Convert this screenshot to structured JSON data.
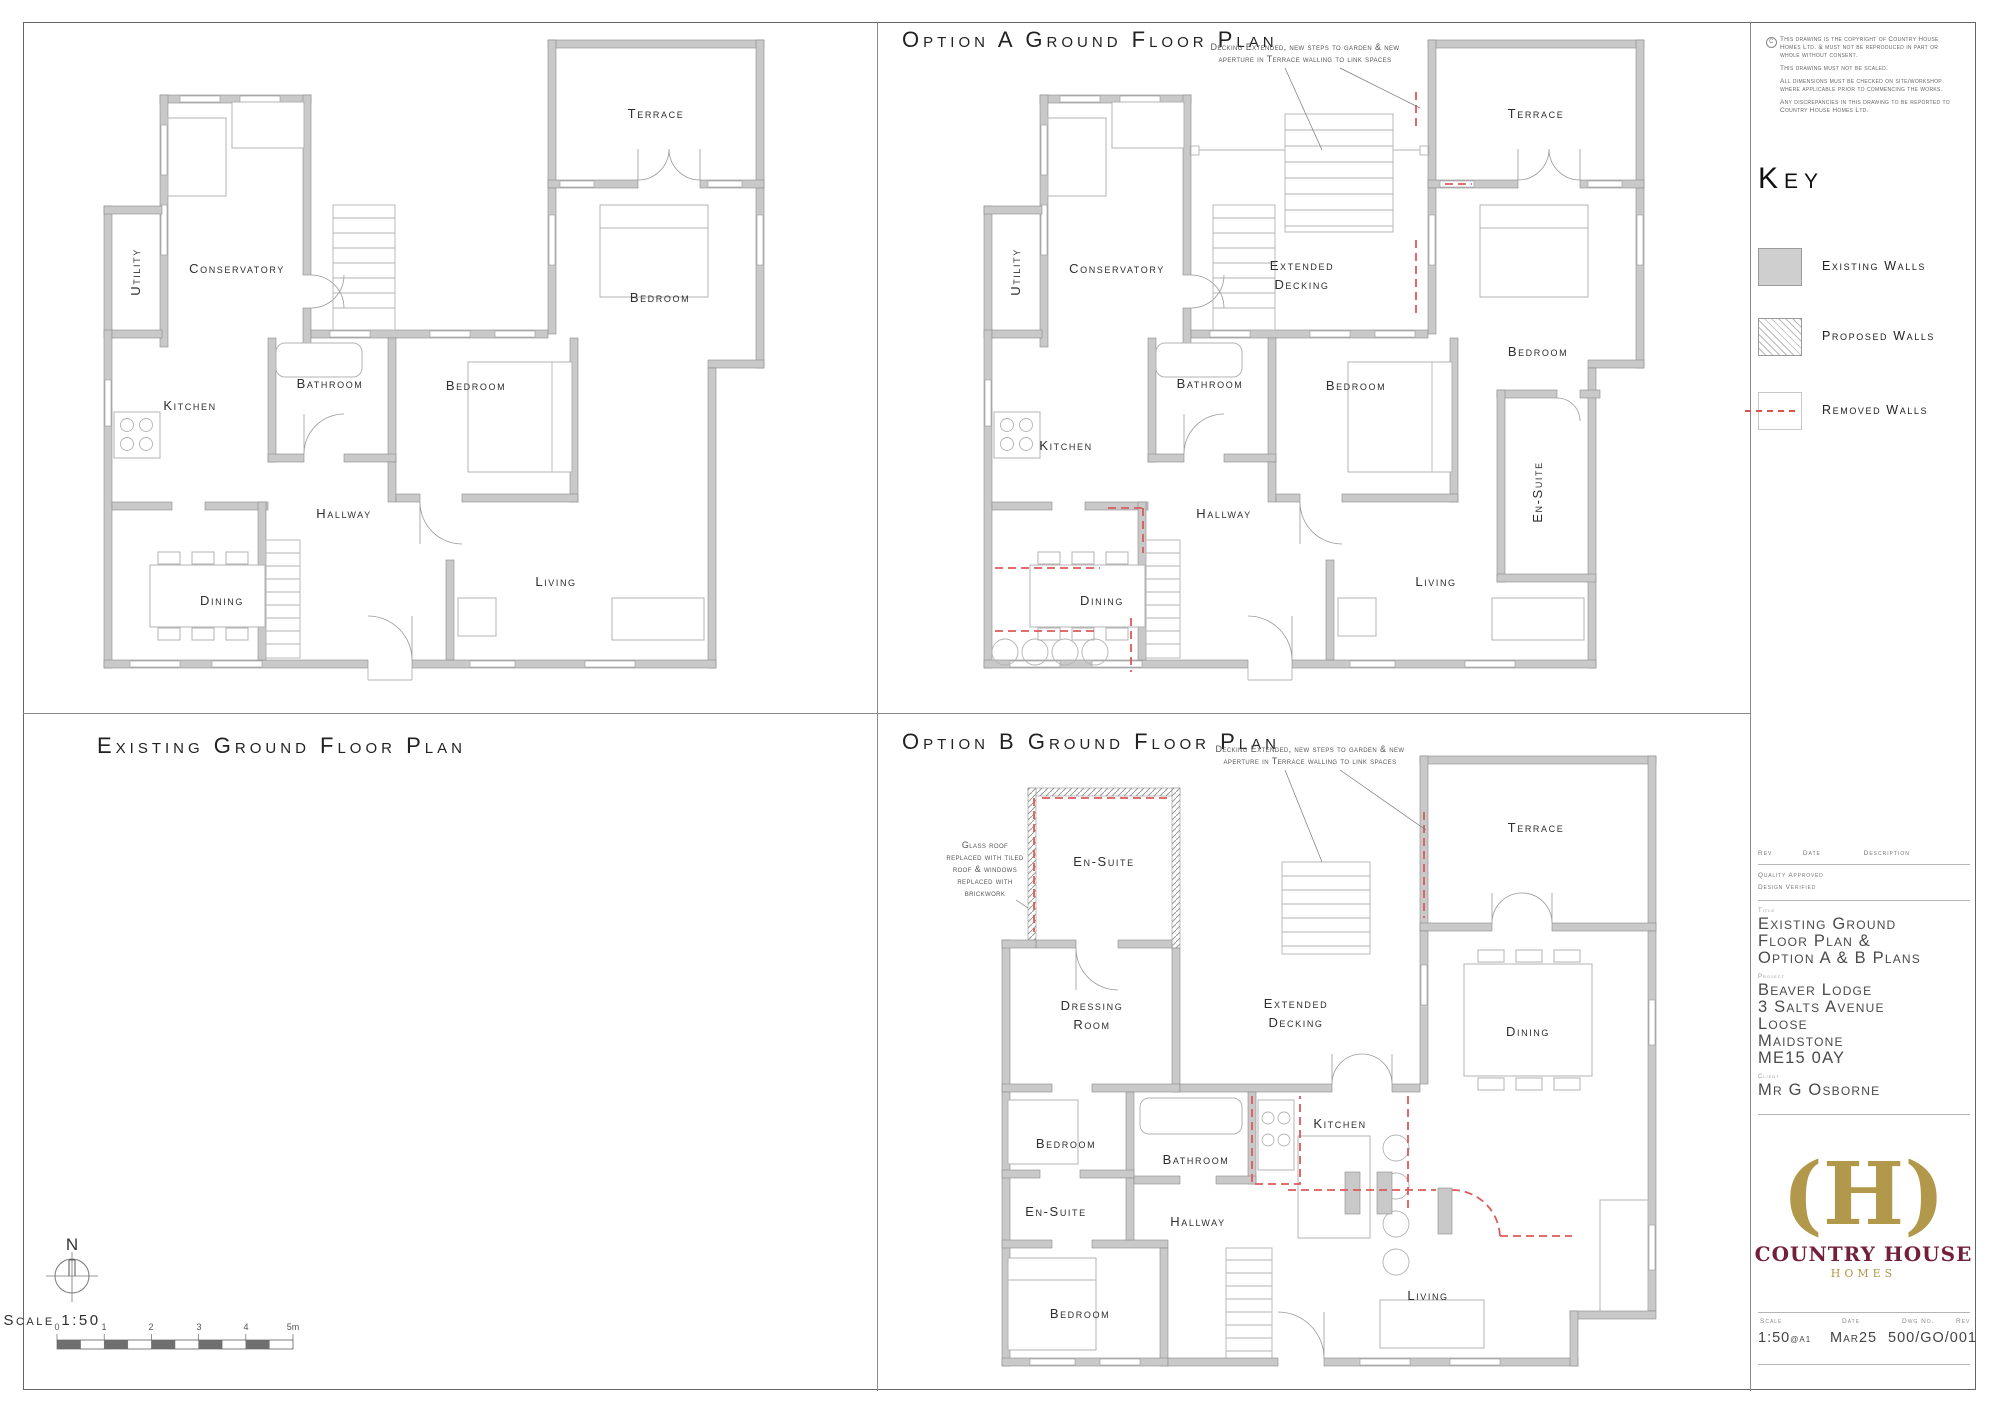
{
  "panels": {
    "existing_title": "Existing Ground Floor Plan",
    "option_a_title": "Option A Ground Floor Plan",
    "option_b_title": "Option B Ground Floor Plan"
  },
  "plans": {
    "existing": {
      "utility": "Utility",
      "conservatory": "Conservatory",
      "terrace": "Terrace",
      "kitchen": "Kitchen",
      "bathroom": "Bathroom",
      "bedroom_middle": "Bedroom",
      "bedroom_right": "Bedroom",
      "hallway": "Hallway",
      "dining": "Dining",
      "living": "Living"
    },
    "option_a": {
      "utility": "Utility",
      "conservatory": "Conservatory",
      "terrace": "Terrace",
      "kitchen": "Kitchen",
      "bathroom": "Bathroom",
      "bedroom_middle": "Bedroom",
      "bedroom_right": "Bedroom",
      "hallway": "Hallway",
      "dining": "Dining",
      "living": "Living",
      "en_suite": "En-Suite",
      "extended_decking_line1": "Extended",
      "extended_decking_line2": "Decking"
    },
    "option_b": {
      "en_suite_top": "En-Suite",
      "dressing_line1": "Dressing",
      "dressing_line2": "Room",
      "extended_decking_line1": "Extended",
      "extended_decking_line2": "Decking",
      "terrace": "Terrace",
      "dining": "Dining",
      "bedroom_middle": "Bedroom",
      "bathroom": "Bathroom",
      "kitchen": "Kitchen",
      "hallway": "Hallway",
      "en_suite_small": "En-Suite",
      "bedroom_bottom": "Bedroom",
      "living": "Living"
    }
  },
  "annotations": {
    "decking_line1": "Decking Extended, new steps to garden & new",
    "decking_line2": "aperture in Terrace walling to link spaces",
    "glass_lines": [
      "Glass roof",
      "replaced with tiled",
      "roof & windows",
      "replaced with",
      "brickwork"
    ]
  },
  "key": {
    "title": "Key",
    "items": [
      {
        "label": "Existing Walls"
      },
      {
        "label": "Proposed Walls"
      },
      {
        "label": "Removed Walls"
      }
    ]
  },
  "copyright": {
    "symbol": "c",
    "lines": [
      "This drawing is the copyright of Country House",
      "Homes Ltd. & must not be reproduced in part or",
      "whole without consent.",
      "This drawing must not be scaled.",
      "All dimensions must be checked on site/workshop",
      "where applicable prior to commencing the works.",
      "Any discrepancies in this drawing to be reported to",
      "Country House Homes Ltd."
    ]
  },
  "revision": {
    "rev_header": "Rev",
    "date_header": "Date",
    "description_header": "Description",
    "quality": "Quality Approved",
    "design": "Design Verified"
  },
  "title_block": {
    "title_label": "Title",
    "title_lines": [
      "Existing Ground",
      "Floor Plan &",
      "Option A & B Plans"
    ],
    "project_label": "Project",
    "project_lines": [
      "Beaver Lodge",
      "3 Salts Avenue",
      "Loose",
      "Maidstone",
      "ME15 0AY"
    ],
    "client_label": "Client",
    "client": "Mr G Osborne"
  },
  "logo": {
    "monogram": "(H)",
    "name": "COUNTRY HOUSE",
    "sub": "HOMES"
  },
  "footer": {
    "scale_label": "Scale",
    "scale_value": "1:50",
    "scale_suffix": "@A1",
    "date_label": "Date",
    "date_value": "Mar25",
    "dwg_label": "Dwg No.",
    "dwg_value": "500/GO/001",
    "rev_label": "Rev"
  },
  "north": {
    "letter": "N"
  },
  "scalebar": {
    "label": "Scale 1:50",
    "ticks": [
      "0",
      "1",
      "2",
      "3",
      "4",
      "5m"
    ]
  }
}
